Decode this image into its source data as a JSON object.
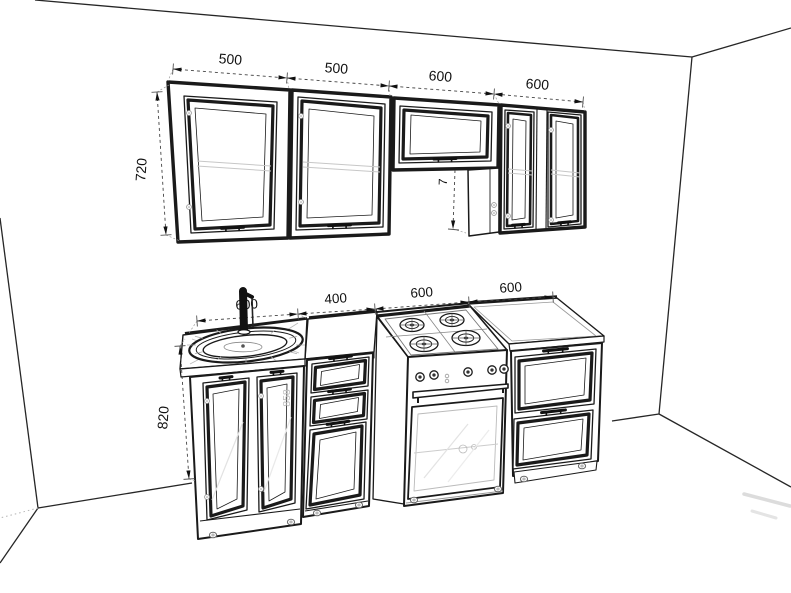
{
  "scene": {
    "description": "Kitchen set technical perspective line drawing in a room corner",
    "background_color": "#ffffff",
    "line_color": "#1a1a1a",
    "faint_color": "#c7c7c7",
    "watermark_color": "#bdbdbd"
  },
  "dimensions": {
    "wall_cabinets": {
      "widths": [
        "500",
        "500",
        "600",
        "600"
      ],
      "height": "720",
      "partial_height": "7"
    },
    "base_cabinets": {
      "widths": [
        "600",
        "400",
        "600",
        "600"
      ],
      "height": "820",
      "door_watermark": "858"
    }
  }
}
